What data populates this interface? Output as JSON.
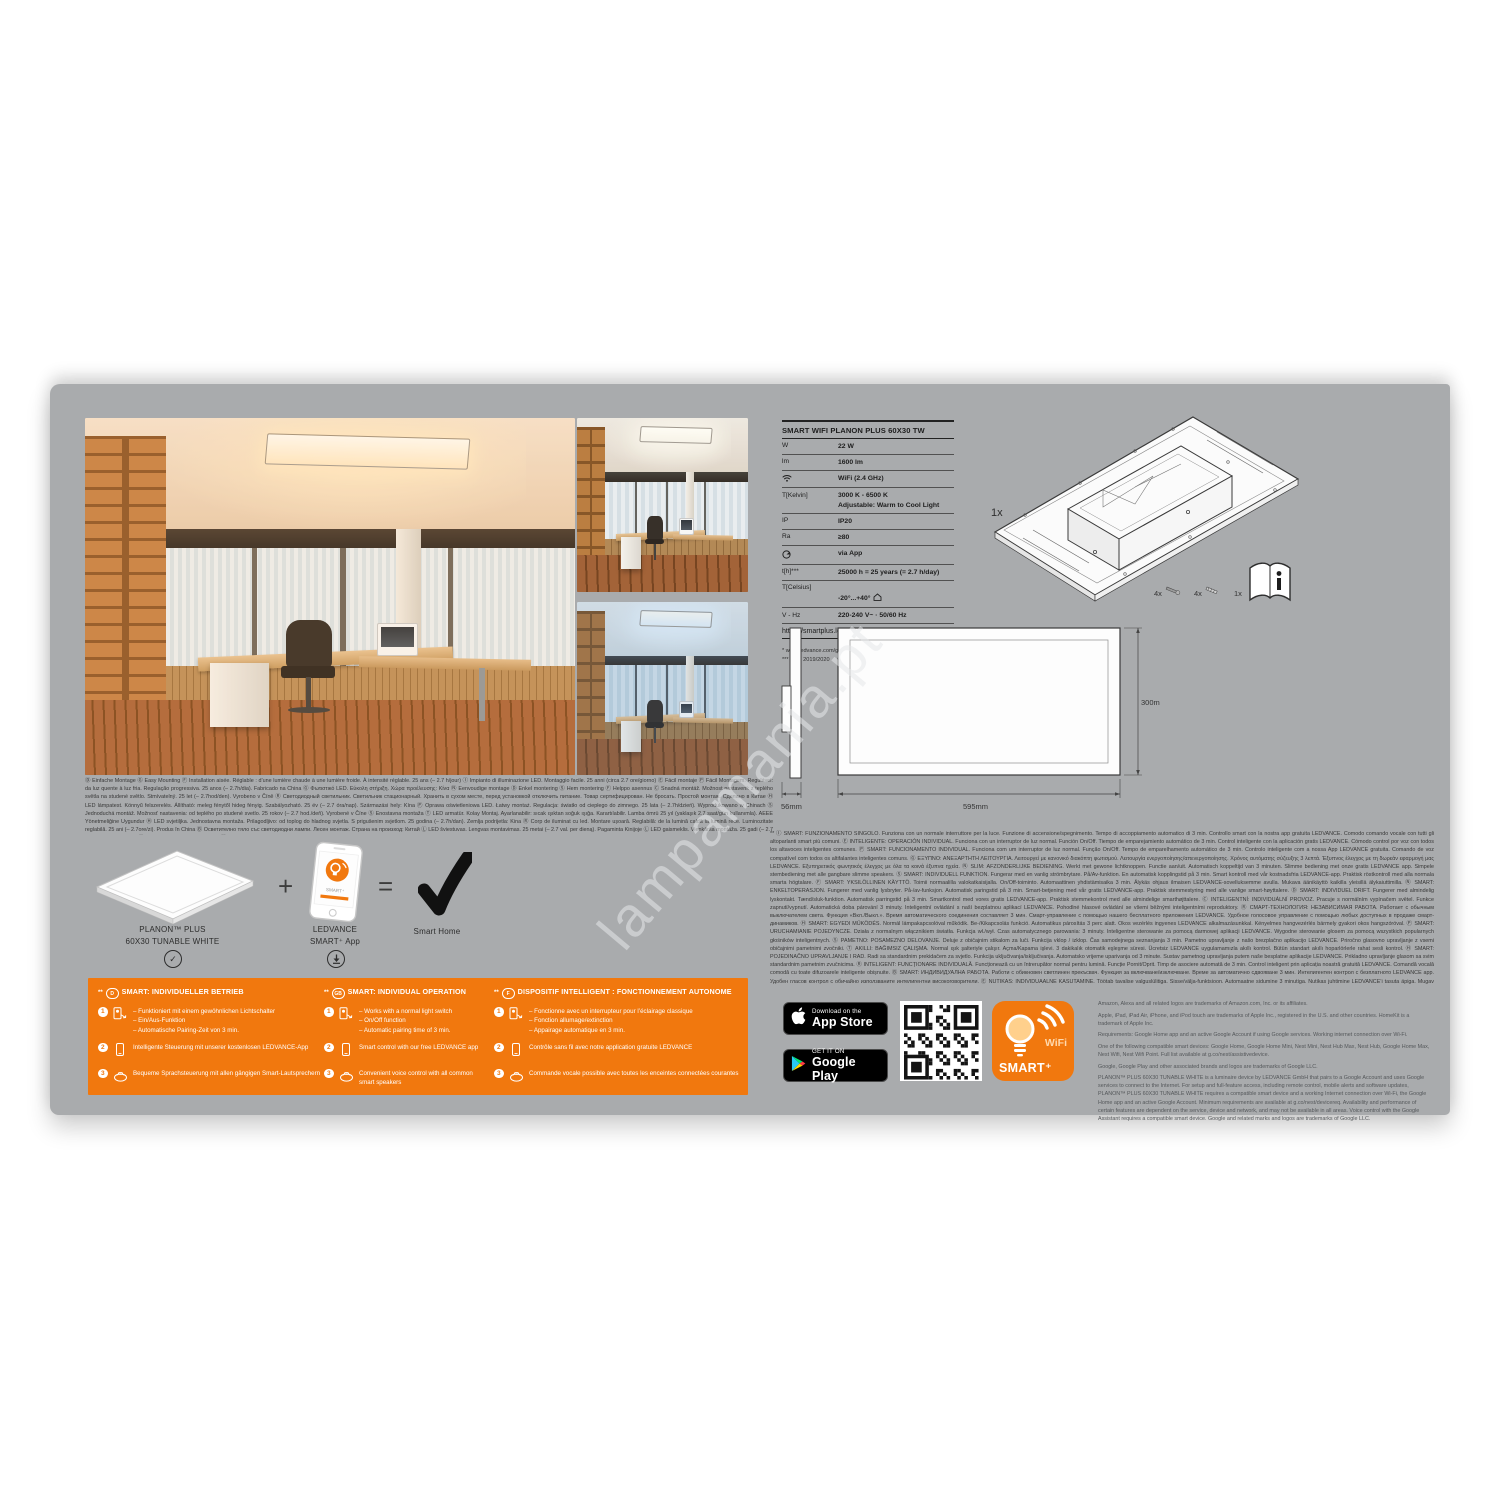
{
  "colors": {
    "accent_orange": "#f1780e",
    "card_gray": "#a9abad"
  },
  "watermark": "lampamania.pt",
  "spec": {
    "title": "SMART WIFI PLANON PLUS 60X30 TW",
    "rows": [
      {
        "label": "W",
        "value": "22 W"
      },
      {
        "label": "lm",
        "value": "1600 lm"
      },
      {
        "label": "",
        "value": "WiFi (2.4 GHz)"
      },
      {
        "label": "T[Kelvin]",
        "value": "3000 K - 6500 K\nAdjustable: Warm to Cool Light"
      },
      {
        "label": "IP",
        "value": "IP20"
      },
      {
        "label": "Ra",
        "value": "≥80"
      },
      {
        "label": "",
        "value": "via App"
      },
      {
        "label": "t[h]***",
        "value": "25000 h = 25 years (= 2.7 h/day)"
      },
      {
        "label": "T[Celsius]",
        "value": "-20°...+40°"
      },
      {
        "label": "V - Hz",
        "value": "220-240 V~ · 50/60 Hz"
      }
    ],
    "link": "https://smartplus.ledvance.com",
    "footnote1": "* www.ledvance.com/guarantee",
    "footnote2": "*** (EU) 2019/2020"
  },
  "drawing": {
    "qty": "1x",
    "screws1": "4x",
    "screws2": "4x",
    "manual": "1x",
    "depth": "56mm",
    "width": "595mm",
    "height": "300mm"
  },
  "paragraph_left": "Ⓓ Einfache Montage Ⓖ Easy Mounting Ⓕ Installation aisée. Réglable : d’une lumière chaude à une lumière froide. À intensité réglable. 25 ans (– 2.7 h/jour) Ⓘ Impianto di illuminazione LED. Montaggio facile. 25 anni (circa 2.7 ore/giorno) Ⓔ Fácil montaje Ⓟ Fácil Montagem. Regulável: da luz quente à luz fria. Regulação progressiva. 25 anos (– 2.7h/dia). Fabricado na China Ⓖ Φωτιστικό LED. Εύκολη στήριξη. Χώρα προέλευσης: Κίνα Ⓝ Eenvoudige montage Ⓓ Enkel montering Ⓢ Hem montering Ⓕ Helppo asennus Ⓒ Snadná montáž. Možnost nastavení: z teplého světla na studené světlo. Stmívatelný. 25 let (– 2.7hod/den). Vyrobeno v Číně Ⓡ Светодиодный светильник. Светильник стационарный. Хранить в сухом месте, перед установкой отключить питание. Товар сертифицирован. Не бросать. Простой монтаж. Сделано в Китае Ⓗ LED lámpatest. Könnyű felszerelés. Állítható: meleg fénytől hideg fényig. Szabályozható. 25 év (– 2.7 óra/nap). Származási hely: Kína Ⓟ Oprawa oświetleniowa LED. Łatwy montaż. Regulacja: światło od ciepłego do zimnego. 25 lata (– 2.7h/dzień). Wyprodukowano w Chinach Ⓢ Jednoduchá montáž. Možnosť nastavenia: od teplého po studené svetlo. 25 rokov (– 2.7 hod./deň). Vyrobené v Číne Ⓢ Enostavna montaža Ⓣ LED armatür. Kolay Montaj. Ayarlanabilir: sıcak ışıktan soğuk ışığa. Karartılabilir. Lamba ömrü 25 yıl (yaklaşık 2.7 saat/gün kullanımla). AEEE Yönetmeliğine Uygundur Ⓗ LED svjetiljka. Jednostavna montaža. Prilagodljivo: od toplog do hladnog svjetla. S prigušenim svjetlom. 25 godina (– 2.7h/dan). Zemlja podrijetla: Kina Ⓡ Corp de iluminat cu led. Montare ușoară. Reglabilă: de la lumină caldă la lumină rece. Luminozitate reglabilă. 25 ani (– 2.7ore/zi). Produs în China Ⓑ Осветително тяло със светодиодни лампи. Лесен монтаж. Страна на произход: Китай Ⓛ LED šviestuvas. Lengvas montavimas. 25 metai (– 2.7 val. per dieną). Pagaminta Kinijoje Ⓛ LED gaismeklis. Vienkārša montāža. 25 gadi (– 2.7 h/dienā). Ražots Ķīnā Ⓔ LED valgusti. Lihtne paigaldus. Ⓚ ЖШД шамдалы. Стационарлық шырақ. Құрғақ жерде сақтап, орнату алдында ток көзінен ажырату керек. Оңай орнату. Жарамдылық мерзімі – 25 жыл (күніне 2.7 сағат жұмыс жасаған жағдайда). Қытайда жасалған",
  "paragraph_right": "** Ⓘ SMART: FUNZIONAMENTO SINGOLO. Funziona con un normale interruttore per la luce. Funzione di accensione/spegnimento. Tempo di accoppiamento automatico di 3 min. Controllo smart con la nostra app gratuita LEDVANCE. Comodo comando vocale con tutti gli altoparlanti smart più comuni. Ⓔ INTELIGENTE: OPERACIÓN INDIVIDUAL. Funciona con un interruptor de luz normal. Función On/Off. Tiempo de emparejamiento automático de 3 min. Control inteligente con la aplicación gratis LEDVANCE. Cómodo control por voz con todos los altavoces inteligentes comunes. Ⓟ SMART: FUNCIONAMENTO INDIVIDUAL. Funciona com um interruptor de luz normal. Função On/Off. Tempo de emparelhamento automático de 3 min. Controlo inteligente com a nossa App LEDVANCE gratuita. Comando de voz compatível com todos os altifalantes inteligentes comuns. Ⓖ ΕΞΥΠΝΟ: ΑΝΕΞΑΡΤΗΤΗ ΛΕΙΤΟΥΡΓΙΑ. Λειτουργεί με κανονικό διακόπτη φωτισμού. Λειτουργία ενεργοποίησης/απενεργοποίησης. Χρόνος αυτόματης σύζευξης 3 λεπτά. Έξυπνος έλεγχος με τη δωρεάν εφαρμογή μας LEDVANCE. Εξυπηρετικός φωνητικός έλεγχος με όλα τα κοινά έξυπνα ηχεία. Ⓝ SLIM: AFZONDERLIJKE BEDIENING. Werkt met gewone lichtknoppen. Functie aan/uit. Automatisch koppeltijd van 3 minuten. Slimme bediening met onze gratis LEDVANCE app. Simpele stembediening met alle gangbare slimme speakers. Ⓢ SMART: INDIVIDUELL FUNKTION. Fungerar med en vanlig strömbrytare. På/Av-funktion. En automatisk kopplingstid på 3 min. Smart kontroll med vår kostnadsfria LEDVANCE-app. Praktisk röstkontroll med alla normala smarta högtalare. Ⓕ SMART: YKSILÖLLINEN KÄYTTÖ. Toimii normaalilla valokatkaisijalla. On/Off-toiminto. Automaattinen yhdistämisaika 3 min. Älykäs ohjaus ilmaisen LEDVANCE-sovelluksemme avulla. Mukava äänikäyttö kaikilla yleisillä älykaiuttimilla. Ⓝ SMART: ENKELTOPERASJON. Fungerer med vanlig lysbryter. På-/av-funksjon. Automatisk paringstid på 3 min. Smart-betjening med vår gratis LEDVANCE-app. Praktisk stemmestyring med alle vanlige smart-høyttalere. Ⓓ SMART: INDIVIDUEL DRIFT. Fungerer med almindelig lyskontakt. Tænd/sluk-funktion. Automatisk parringstid på 3 min. Smartkontrol med vores gratis LEDVANCE-app. Praktisk stemmekontrol med alle almindelige smarthøjttalere. Ⓒ INTELIGENTNÍ: INDIVIDUÁLNÍ PROVOZ. Pracuje s normálním vypínačem světel. Funkce zapnutí/vypnutí. Automatická doba párování 3 minuty. Inteligentní ovládání s naší bezplatnou aplikací LEDVANCE. Pohodlné hlasové ovládání se všemi běžnými inteligentními reproduktory. Ⓡ СМАРТ-ТЕХНОЛОГИЯ: НЕЗАВИСИМАЯ РАБОТА. Работает с обычным выключателем света. Функция «Вкл./Выкл.». Время автоматического соединения составляет 3 мин. Смарт-управление с помощью нашего бесплатного приложения LEDVANCE. Удобное голосовое управление с помощью любых доступных в продаже смарт-динамиков. Ⓗ SMART: EGYEDI MŰKÖDÉS. Normál lámpakapcsolóval működik. Be-/Kikapcsolás funkció. Automatikus párosítás 3 perc alatt. Okos vezérlés ingyenes LEDVANCE alkalmazásunkkal. Kényelmes hangvezérlés bármely gyakori okos hangszóróval. Ⓟ SMART: URUCHAMIANIE POJEDYNCZE. Działa z normalnym włącznikiem światła. Funkcja wł./wył. Czas automatycznego parowania: 3 minuty. Inteligentne sterowanie za pomocą darmowej aplikacji LEDVANCE. Wygodne sterowanie głosem za pomocą wszystkich popularnych głośników inteligentnych. Ⓢ PAMETNO: POSAMEZNO DELOVANJE. Deluje z običajnim stikalom za luči. Funkcija vklop / izklop. Čas samodejnega seznanjanja 3 min. Pametno upravljanje z našo brezplačno aplikacijo LEDVANCE. Priročno glasovno upravljanje z vsemi običajnimi pametnimi zvočniki. Ⓣ AKILLI: BAĞIMSIZ ÇALIŞMA. Normal ışık şalteriyle çalışır. Açma/Kapama işlevi. 3 dakikalık otomatik eşleşme süresi. Ücretsiz LEDVANCE uygulamamızla akıllı kontrol. Bütün standart akıllı hoparlörlerle rahat sesli kontrol. Ⓗ SMART: POJEDINAČNO UPRAVLJANJE I RAD. Radi sa standardnim prekidačem za svjetlo. Funkcija uključivanja/isključivanja. Automatsko vrijeme uparivanja od 3 minute. Sustav pametnog upravljanja putem naše besplatne aplikacije LEDVANCE. Prikladno upravljanje glasom sa svim standardnim pametnim zvučnicima. Ⓡ INTELIGENT: FUNCȚIONARE INDIVIDUALĂ. Funcționează cu un întrerupător normal pentru lumină. Funcție Pornit/Oprit. Timp de asociere automată de 3 min. Control inteligent prin aplicația noastră gratuită LEDVANCE. Comandă vocală comodă cu toate difuzoarele inteligente obișnuite. Ⓑ SMART: ИНДИВИДУАЛНА РАБОТА. Работи с обикновен светлинен прекъсвач. Функция за включване/изключване. Време за автоматично сдвояване 3 мин. Интелигентен контрол с безплатното LEDVANCE app. Удобен гласов контрол с обичайно използваните интелигентни високоговорители. Ⓔ NUTIKAS: INDIVIDUAALNE KASUTAMINE. Töötab tavalise valguslülitiga. Sisse/välja-funktsioon. Automaatne sidumine 3 minutiga. Nutikas juhtimine LEDVANCE’i tasuta äpiga. Mugav häältjuhtimine kõigi levinumate nutikõlaritega. Ⓛ IŠMANU: INDIVIDUALUS VEIKIMAS. Veikia su įprastu šviesos jungikliu. Įjungimo / išjungimo funkcija. Automatinis susiejimo laikas – 3 min. Išmanus valdymas naudojant nemokamą „LEDVANCE“ programėlę. Patogus valdymas balsu naudojant visus įprastus išmaniuosius garsiakalbius. Ⓥ VIEDI: INDIVIDUĀLA DARBĪBA. Darbojas ar parasto gaismas slēdzi. Ieslēgšanas/izslēgšanas funkcija. Automātiskais savienošanas laiks – 3 minūtes. Vieda vadība ar mūsu bezmaksas lietotni LEDVANCE. Ērta balss vadība ar visiem parastajiem viedajiem skaļruņiem. Ⓤ СМАРТ-ТЕХНОЛОГІЯ: НЕЗАЛЕЖНА РОБОТА. Працює зі звичайним вимикачем світла. Функція «Увімк./Вимк.». Час автоматичного з’єднання становить 3 хв. Смарт-керування за допомогою нашої безкоштовної програми LEDVANCE. Зручне голосове керування за допомогою будь-яких доступних у продажу смарт-динаміків. Ⓚ СМАРТ: ЖЕКЕ ПАЙДАЛАНУ. Қалыпты шам қосқышымен жұмыс істейді. Қосу/Өшіру функциясы. Автоматты түрде жұптастыру уақыты: 3 мин. Косу/Өшіру функциялары. Автоматты түрде жұптастыру уақыты: 3 мин. Тегін LEDVANCE қолданбамызбен тегін басқару. Барлық кәдімгі смарт динамиктермен дыбыс арқылы ыңғайлы басқару.",
  "products": {
    "panel_label": "PLANON™ PLUS\n60X30 TUNABLE WHITE",
    "plus": "+",
    "app_label": "LEDVANCE\nSMART⁺ App",
    "equals": "=",
    "result_label": "Smart Home"
  },
  "item_numbers": [
    "1",
    "2",
    "3"
  ],
  "smart_sections": [
    {
      "stars": "**",
      "lang": "D",
      "title": "SMART: INDIVIDUELLER BETRIEB",
      "item1": "– Funktioniert mit einem gewöhnlichen Lichtschalter\n– Ein/Aus-Funktion\n– Automatische Pairing-Zeit von 3 min.",
      "item2": "Intelligente Steuerung mit unserer kostenlosen LEDVANCE-App",
      "item3": "Bequeme Sprachsteuerung mit allen gängigen Smart-Lautsprechern"
    },
    {
      "stars": "**",
      "lang": "GB",
      "title": "SMART: INDIVIDUAL OPERATION",
      "item1": "– Works with a normal light switch\n– On/Off function\n– Automatic pairing time of 3 min.",
      "item2": "Smart control with our free LEDVANCE app",
      "item3": "Convenient voice control with all common smart speakers"
    },
    {
      "stars": "**",
      "lang": "F",
      "title": "DISPOSITIF INTELLIGENT : FONCTIONNEMENT AUTONOME",
      "item1": "– Fonctionne avec un interrupteur pour l’éclairage classique\n– Fonction allumage/extinction\n– Appairage automatique en 3 min.",
      "item2": "Contrôle sans fil avec notre application gratuite LEDVANCE",
      "item3": "Commande vocale possible avec toutes les enceintes connectées courantes"
    }
  ],
  "badges": {
    "app_store_line1": "Download on the",
    "app_store_line2": "App Store",
    "google_play_line1": "GET IT ON",
    "google_play_line2": "Google Play"
  },
  "smart_logo": {
    "wifi": "WiFi",
    "brand": "SMART⁺"
  },
  "legal": [
    "Amazon, Alexa and all related logos are trademarks of Amazon.com, Inc. or its affiliates.",
    "Apple, iPad, iPad Air, iPhone, and iPod touch are trademarks of Apple Inc., registered in the U.S. and other countries. HomeKit is a trademark of Apple Inc.",
    "Requirements: Google Home app and an active Google Account if using Google services. Working internet connection over Wi-Fi.",
    "One of the following compatible smart devices: Google Home, Google Home Mini, Nest Mini, Nest Hub Max, Nest Hub, Google Home Max, Nest Wifi, Nest Wifi Point. Full list available at g.co/nest/assistivedevice.",
    "Google, Google Play and other associated brands and logos are trademarks of Google LLC.",
    "PLANON™ PLUS 60X30 TUNABLE WHITE is a luminaire device by LEDVANCE GmbH that pairs to a Google Account and uses Google services to connect to the Internet. For setup and full-feature access, including remote control, mobile alerts and software updates, PLANON™ PLUS 60X30 TUNABLE WHITE requires a compatible smart device and a working Internet connection over Wi-Fi, the Google Home app and an active Google Account. Minimum requirements are available at g.co/nest/devicereq. Availability and performance of certain features are dependent on the service, device and network, and may not be available in all areas. Voice control with the Google Assistant requires a compatible smart device. Google and related marks and logos are trademarks of Google LLC."
  ]
}
